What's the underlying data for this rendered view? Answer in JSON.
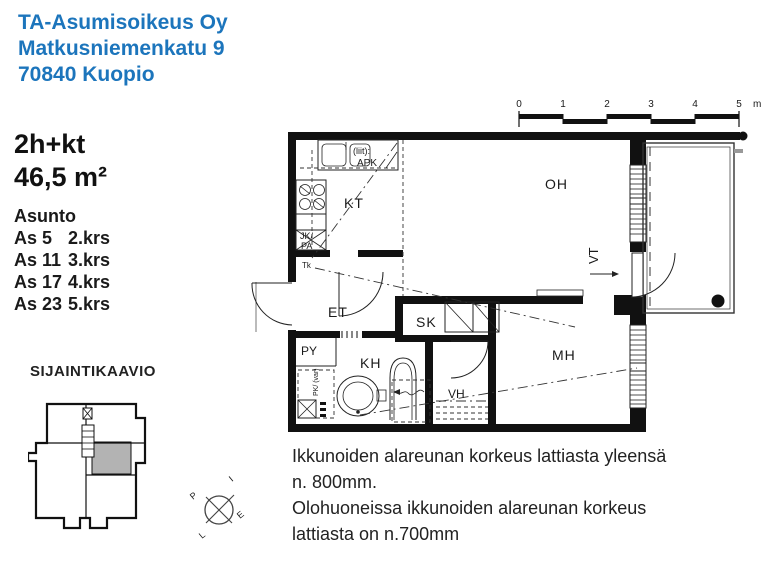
{
  "header": {
    "line1": "TA-Asumisoikeus Oy",
    "line2": "Matkusniemenkatu 9",
    "line3": "70840 Kuopio",
    "color": "#1c75bc"
  },
  "apartment": {
    "type": "2h+kt",
    "area": "46,5 m²",
    "list_heading": "Asunto",
    "units": [
      {
        "unit": "As 5",
        "floor": "2.krs"
      },
      {
        "unit": "As 11",
        "floor": "3.krs"
      },
      {
        "unit": "As 17",
        "floor": "4.krs"
      },
      {
        "unit": "As 23",
        "floor": "5.krs"
      }
    ]
  },
  "location_diagram": {
    "title": "SIJAINTIKAAVIO",
    "highlight_color": "#b3b3b3"
  },
  "floor_plan": {
    "room_labels": {
      "kt": "KT",
      "oh": "OH",
      "et": "ET",
      "sk": "SK",
      "kh": "KH",
      "py": "PY",
      "vh": "VH",
      "mh": "MH"
    },
    "annotations": {
      "vt": "VT",
      "tk": "Tk",
      "jk": "JK/",
      "pa": "PA",
      "apk_note": "(liit):",
      "apk": "APK",
      "py_note": "PK/ (var)"
    },
    "scale_bar": {
      "ticks": [
        "0",
        "1",
        "2",
        "3",
        "4",
        "5"
      ],
      "unit": "m"
    }
  },
  "compass": {
    "north": "P",
    "east": "I",
    "south": "E",
    "west": "L"
  },
  "notes": {
    "line1": "Ikkunoiden alareunan korkeus lattiasta yleensä",
    "line2": "n. 800mm.",
    "line3": "Olohuoneissa ikkunoiden alareunan korkeus",
    "line4": "lattiasta on n.700mm"
  }
}
